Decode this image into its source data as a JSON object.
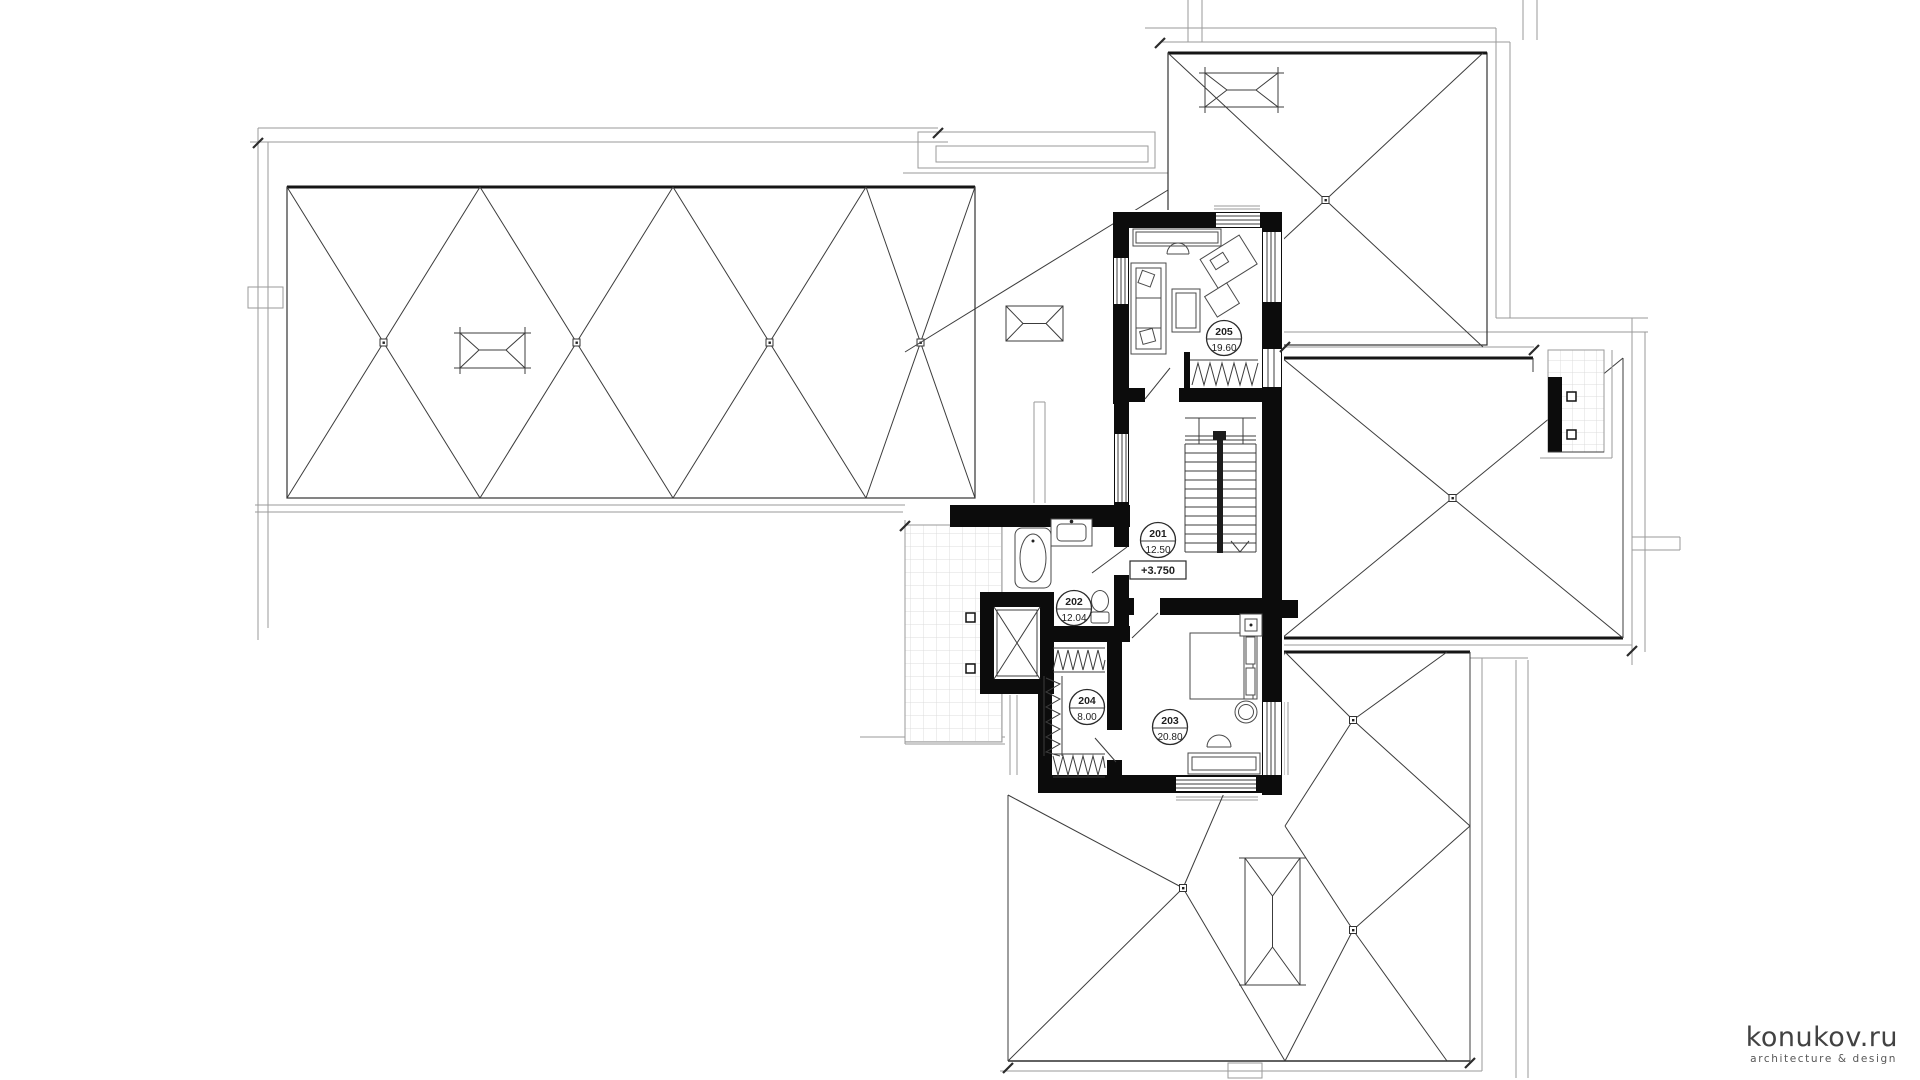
{
  "plan": {
    "rooms": [
      {
        "number": "201",
        "area": "12.50"
      },
      {
        "number": "202",
        "area": "12.04"
      },
      {
        "number": "203",
        "area": "20.80"
      },
      {
        "number": "204",
        "area": "8.00"
      },
      {
        "number": "205",
        "area": "19.60"
      }
    ],
    "elevation_label": "+3.750"
  },
  "branding": {
    "brand": "konukov.ru",
    "tagline": "architecture & design"
  },
  "colors": {
    "wall": "#0c0c0c",
    "drawing_line": "#3c3c3c",
    "parapet_line": "#9a9a9a",
    "tile_line": "#dcdcdc",
    "label_ink": "#1f1f1f",
    "logo_ink": "#424242"
  }
}
